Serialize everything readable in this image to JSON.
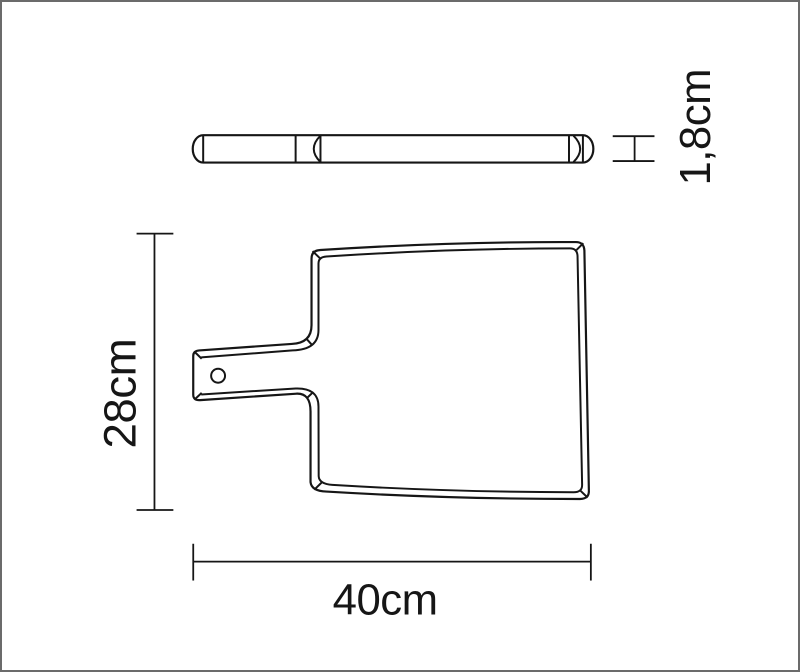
{
  "labels": {
    "thickness": "1,8cm",
    "height": "28cm",
    "width": "40cm"
  },
  "colors": {
    "line": "#161616",
    "background": "#ffffff",
    "frame": "#6b6b6b"
  }
}
